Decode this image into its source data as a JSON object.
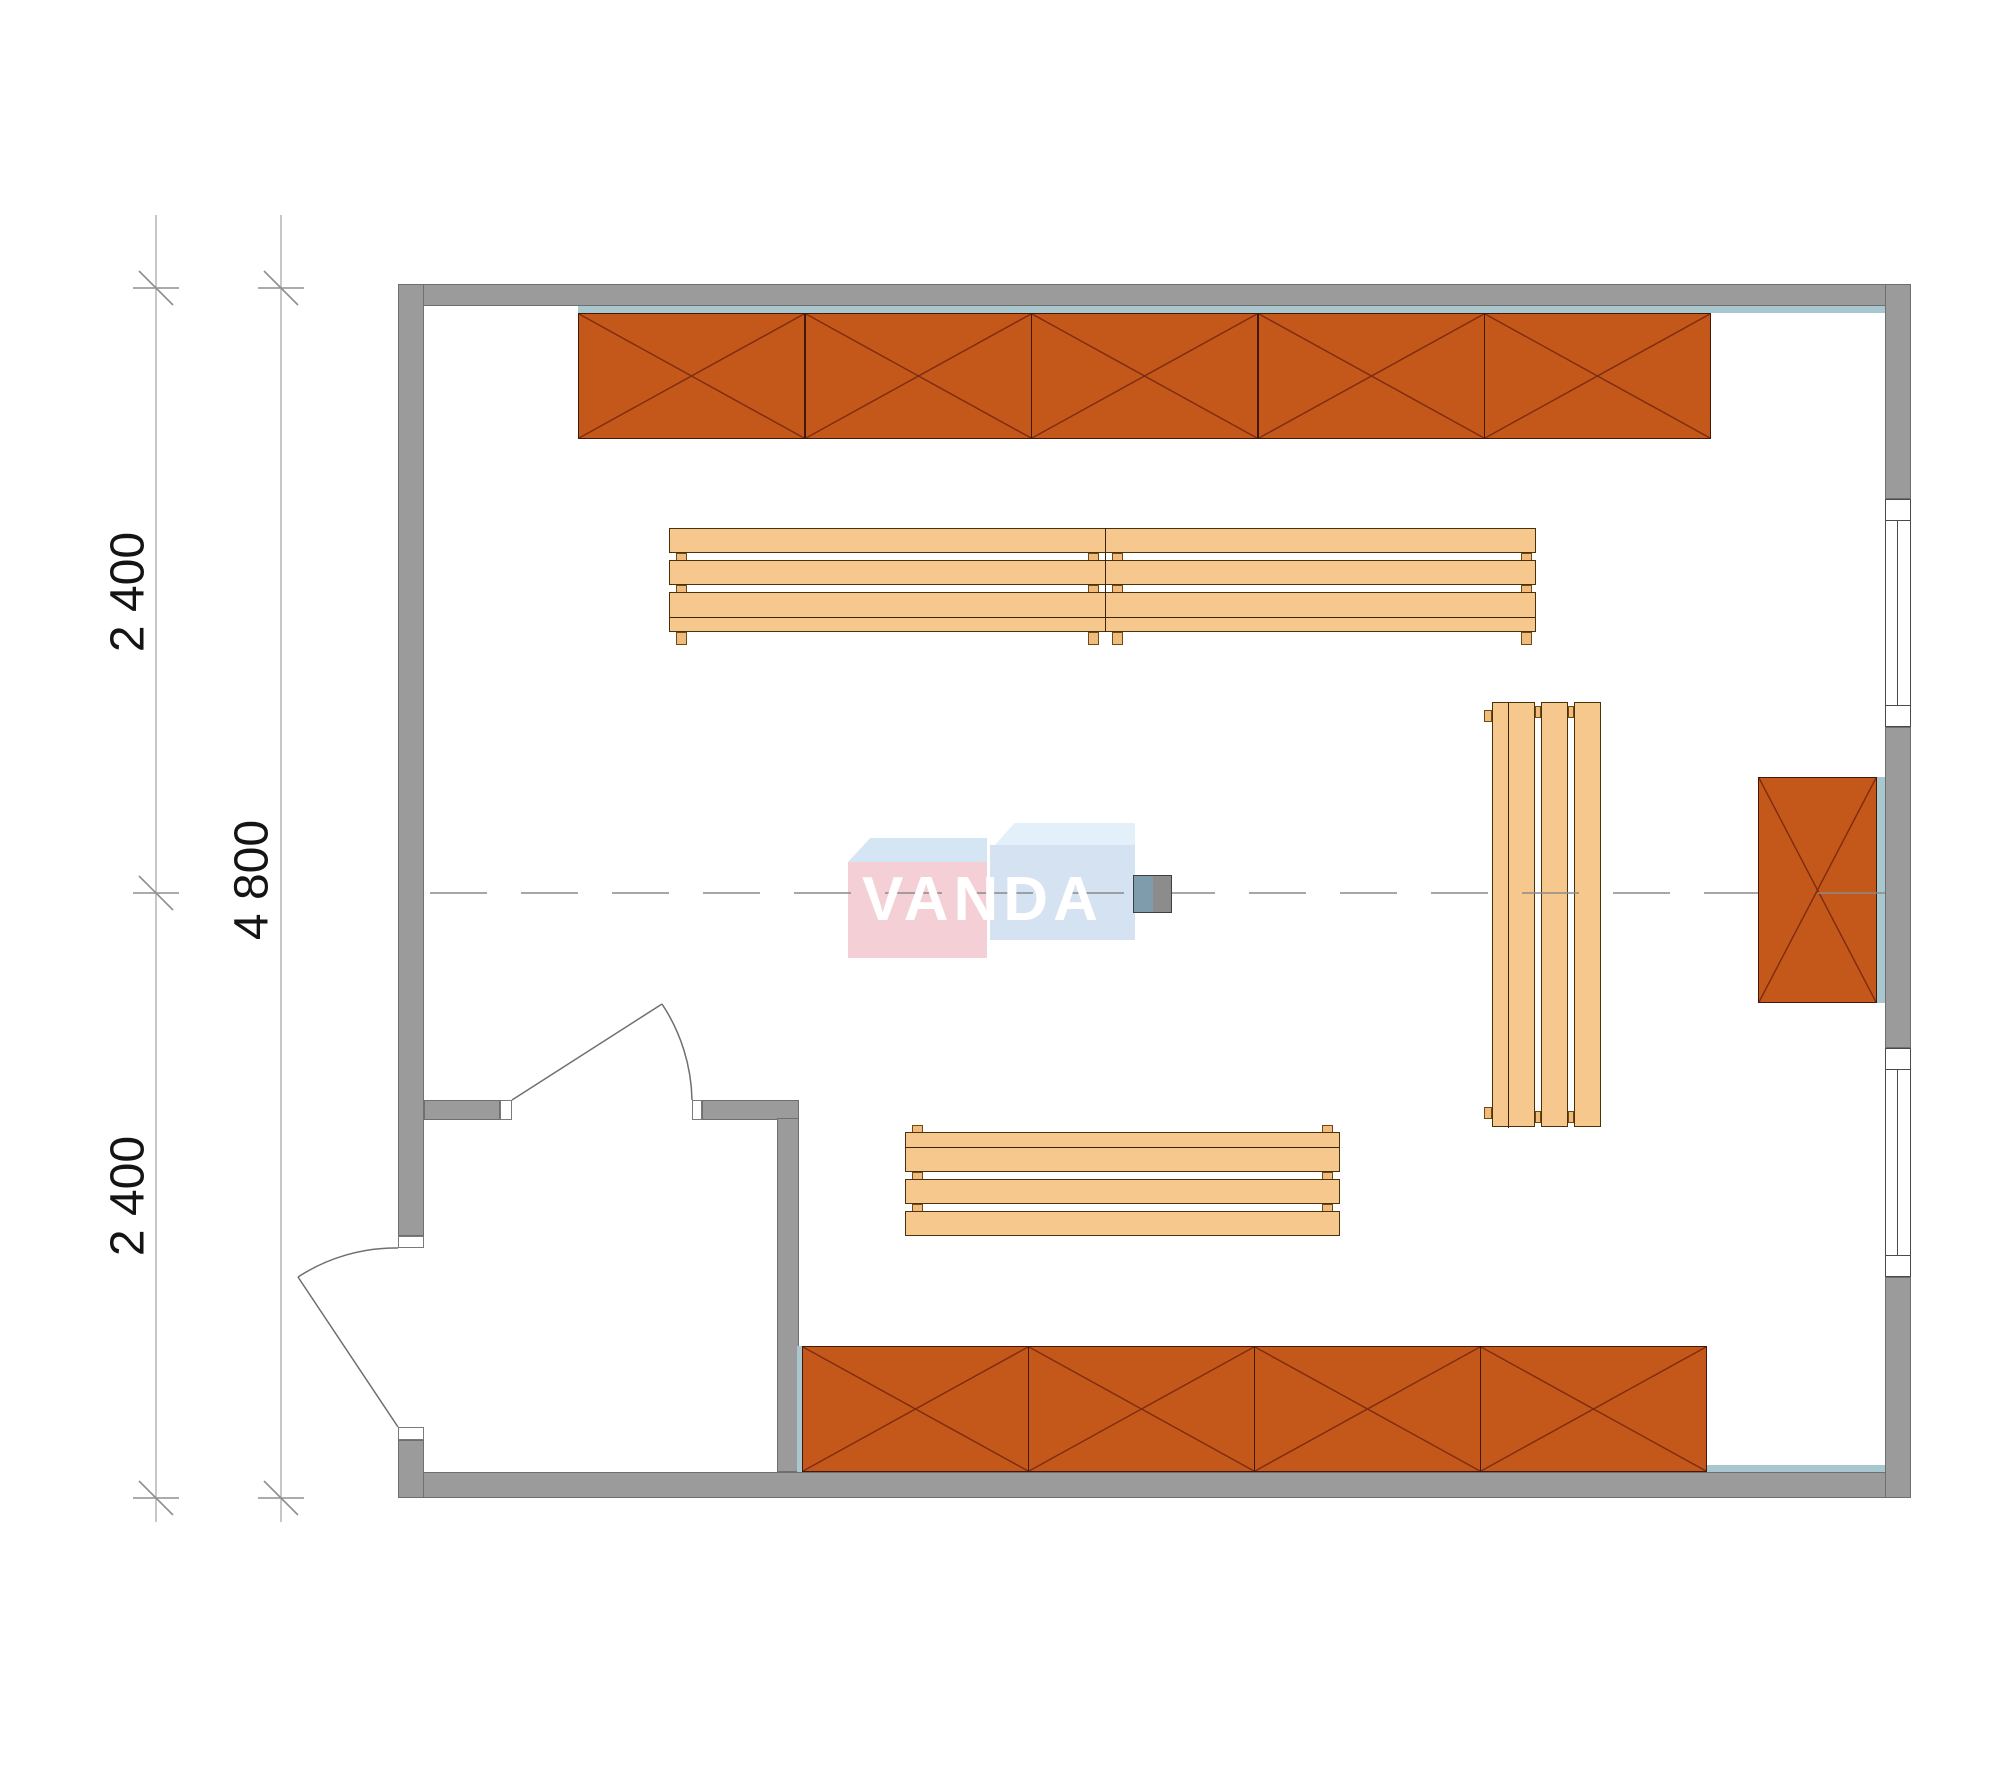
{
  "document": {
    "type": "architectural floor plan, top view (sauna / room layout)",
    "background": "#ffffff"
  },
  "dimension_labels": {
    "vertical_chain_top": "2 400",
    "vertical_chain_bottom": "2 400",
    "vertical_total": "4 800"
  },
  "watermark": {
    "text": "VANDA"
  },
  "plan_contents": {
    "shelving_units_top_wall": 5,
    "shelving_units_bottom_wall": 4,
    "shelving_units_right_wall": 1,
    "benches_horizontal_top": 2,
    "benches_horizontal_bottom": 1,
    "benches_vertical_right": 1,
    "windows_right_wall": 2,
    "doors": 2,
    "heater_on_centerline": 1
  },
  "colors": {
    "wall_gray": "#9b9b9b",
    "accent_teal": "#a9c7cf",
    "cabinet_orange": "#c4571a",
    "cabinet_cross_line": "#7c2b10",
    "bench_wood": "#f7c88e",
    "watermark_pink": "#f2c7ce",
    "watermark_blue": "#cdddee",
    "centerline_gray": "#8a8a8a",
    "dimension_text": "#141414"
  }
}
